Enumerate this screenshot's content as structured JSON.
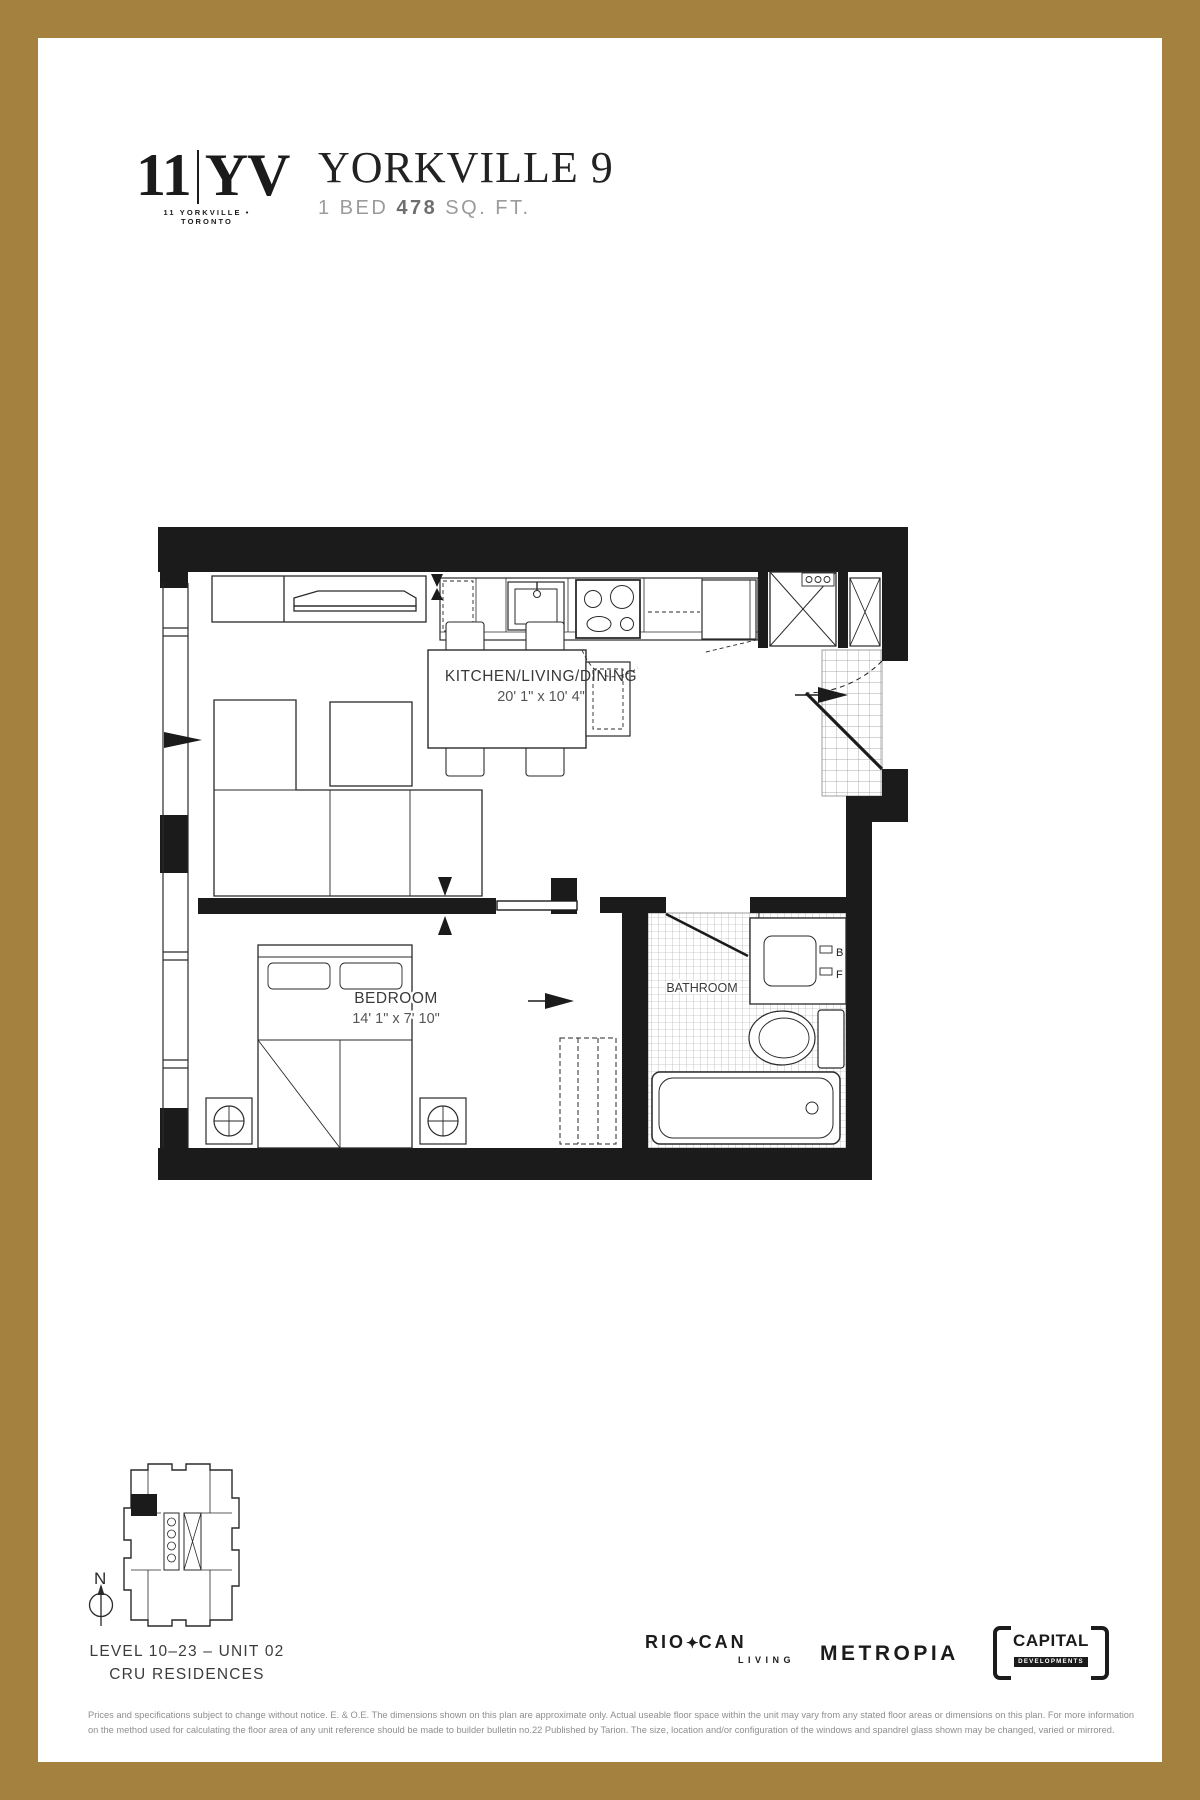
{
  "page": {
    "frame_color": "#a5813f"
  },
  "header": {
    "logo_number": "11",
    "logo_letters": "YV",
    "logo_tagline": "11 YORKVILLE • TORONTO",
    "title": "YORKVILLE 9",
    "spec_bed": "1 BED ",
    "spec_sqft": "478",
    "spec_sqft_label": " SQ. FT."
  },
  "floorplan": {
    "kitchen_label": "KITCHEN/LIVING/DINING",
    "kitchen_dims": "20' 1\" x 10' 4\"",
    "bedroom_label": "BEDROOM",
    "bedroom_dims": "14' 1\" x 7' 10\"",
    "bathroom_label": "BATHROOM",
    "vanity_label_b": "B",
    "vanity_label_f": "F"
  },
  "keyplan": {
    "compass_label": "N",
    "level_text": "LEVEL 10–23 – UNIT 02",
    "residence_text": "CRU RESIDENCES"
  },
  "logos": {
    "riocan_left": "RIO",
    "riocan_star": "✦",
    "riocan_right": "CAN",
    "riocan_sub": "LIVING",
    "metropia": "METROPIA",
    "capital_main": "CAPITAL",
    "capital_sub": "DEVELOPMENTS"
  },
  "fine_print": {
    "line1": "Prices and specifications subject to change without notice. E. & O.E. The dimensions shown on this plan are approximate only. Actual useable floor space within the unit may vary from any stated floor areas or dimensions on this plan. For more information",
    "line2": "on the method used for calculating the floor area of any unit reference should be made to builder bulletin no.22 Published by Tarion. The size, location and/or configuration of the windows and spandrel glass shown may be changed, varied or mirrored."
  }
}
